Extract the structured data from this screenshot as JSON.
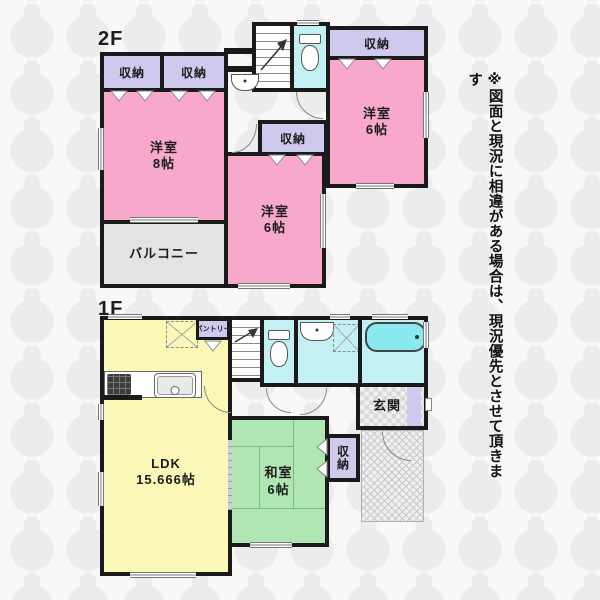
{
  "note": {
    "text": "※図面と現況に相違がある場合は、現況優先とさせて頂きます"
  },
  "floor2": {
    "label": "2F",
    "rooms": {
      "closet_a": "収納",
      "closet_b": "収納",
      "closet_top_right": "収納",
      "closet_mid": "収納",
      "west8": {
        "name": "洋室",
        "size": "8帖"
      },
      "west6_right": {
        "name": "洋室",
        "size": "6帖"
      },
      "west6_mid": {
        "name": "洋室",
        "size": "6帖"
      },
      "balcony": "バルコニー"
    }
  },
  "floor1": {
    "label": "1F",
    "rooms": {
      "ldk": {
        "name": "LDK",
        "size": "15.666帖"
      },
      "pantry": "パントリー",
      "washitsu": {
        "name": "和室",
        "size": "6帖"
      },
      "closet": "収納",
      "genkan": "玄関"
    }
  },
  "icons": {
    "toilet": "toilet-icon",
    "washbasin": "washbasin-icon",
    "bathtub": "bathtub-icon",
    "stove": "stove-icon",
    "sink": "sink-icon",
    "stairs_arrow": "stairs-direction-arrow-icon",
    "fridge_space": "dashed-appliance-space",
    "washer_space": "dashed-appliance-space"
  },
  "colors": {
    "wall": "#1a1a1a",
    "room_pink": "#F8A9CB",
    "closet_lavender": "#CFC9ED",
    "wet_cyan": "#C3F0F3",
    "tub_cyan": "#8AE9ED",
    "ldk_yellow": "#FBF7B7",
    "tatami_green": "#AFE6B3",
    "balcony_gray": "#E3E3E3",
    "bg": "#F8F8F9",
    "watermark": "#ECECEF"
  }
}
